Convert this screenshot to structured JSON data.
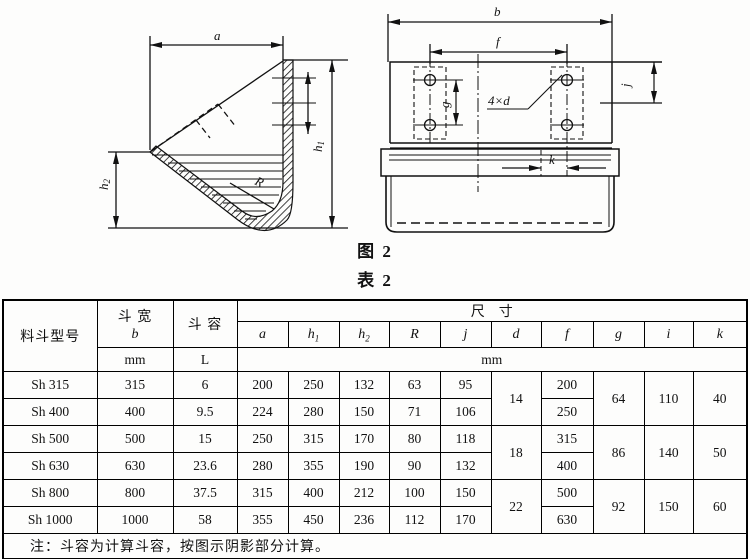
{
  "figure": {
    "caption_fig": "图  2",
    "caption_table": "表  2",
    "left_view": {
      "dim_a": "a",
      "h1_base": "h",
      "h1_sub": "1",
      "h2_base": "h",
      "h2_sub": "2",
      "dim_R": "R"
    },
    "right_view": {
      "dim_b": "b",
      "dim_f": "f",
      "dim_g": "g",
      "dim_j": "j",
      "dim_k": "k",
      "holes_label": "4×d"
    }
  },
  "table": {
    "headers": {
      "model": "料斗型号",
      "width_label": "斗 宽",
      "width_sym": "b",
      "width_unit": "mm",
      "volume_label": "斗  容",
      "volume_unit": "L",
      "dims_label": "尺寸",
      "dims_unit": "mm",
      "sym_a": "a",
      "sym_h1_base": "h",
      "sym_h1_sub": "1",
      "sym_h2_base": "h",
      "sym_h2_sub": "2",
      "sym_R": "R",
      "sym_j": "j",
      "sym_d": "d",
      "sym_f": "f",
      "sym_g": "g",
      "sym_i": "i",
      "sym_k": "k"
    },
    "rows": [
      {
        "model": "Sh 315",
        "b": "315",
        "vol": "6",
        "a": "200",
        "h1": "250",
        "h2": "132",
        "R": "63",
        "j": "95",
        "d": "14",
        "f": "200",
        "g": "64",
        "i": "110",
        "k": "40"
      },
      {
        "model": "Sh 400",
        "b": "400",
        "vol": "9.5",
        "a": "224",
        "h1": "280",
        "h2": "150",
        "R": "71",
        "j": "106",
        "f": "250"
      },
      {
        "model": "Sh 500",
        "b": "500",
        "vol": "15",
        "a": "250",
        "h1": "315",
        "h2": "170",
        "R": "80",
        "j": "118",
        "d": "18",
        "f": "315",
        "g": "86",
        "i": "140",
        "k": "50"
      },
      {
        "model": "Sh 630",
        "b": "630",
        "vol": "23.6",
        "a": "280",
        "h1": "355",
        "h2": "190",
        "R": "90",
        "j": "132",
        "f": "400"
      },
      {
        "model": "Sh 800",
        "b": "800",
        "vol": "37.5",
        "a": "315",
        "h1": "400",
        "h2": "212",
        "R": "100",
        "j": "150",
        "d": "22",
        "f": "500",
        "g": "92",
        "i": "150",
        "k": "60"
      },
      {
        "model": "Sh 1000",
        "b": "1000",
        "vol": "58",
        "a": "355",
        "h1": "450",
        "h2": "236",
        "R": "112",
        "j": "170",
        "f": "630"
      }
    ],
    "note": "注：斗容为计算斗容，按图示阴影部分计算。"
  }
}
